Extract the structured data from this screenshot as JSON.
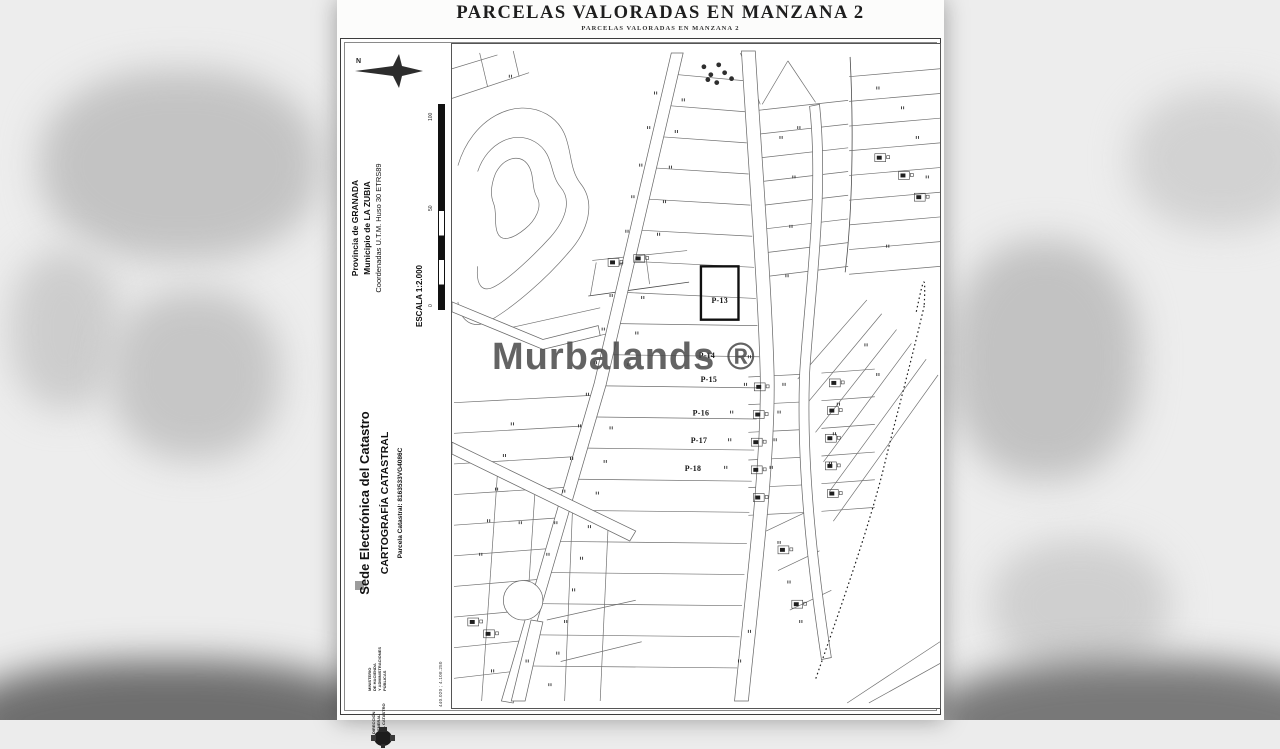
{
  "viewer": {
    "watermark": "Murbalands ®"
  },
  "document": {
    "title": "PARCELAS VALORADAS EN MANZANA 2",
    "subtitle": "PARCELAS VALORADAS EN MANZANA 2",
    "header": {
      "north_label": "N",
      "province": "Provincia de GRANADA",
      "municipality": "Municipio de LA ZUBIA",
      "utm": "Coordenadas U.T.M. Huso 30 ETRS89",
      "scale": "ESCALA 1:2.000",
      "scale_ticks": [
        "100",
        "50",
        "0"
      ]
    },
    "branding": {
      "site": "Sede Electrónica del Catastro",
      "section": "CARTOGRAFÍA CATASTRAL",
      "parcel_ref": "Parcela Catastral: 8163533VG4086C"
    },
    "footer": {
      "ministry": "MINISTERIO\nDE HACIENDA\nY ADMINISTRACIONES\nPÚBLICAS",
      "catastro": "DIRECCIÓN GENERAL\nDEL CATASTRO"
    },
    "frame_coords": {
      "top": "440.020 ; 4.106.250",
      "bottom": "440.020 ; 4.108.250"
    },
    "map_labels": {
      "p13": "P-13",
      "p14": "P-14",
      "p15": "P-15",
      "p16": "P-16",
      "p17": "P-17",
      "p18": "P-18"
    }
  }
}
